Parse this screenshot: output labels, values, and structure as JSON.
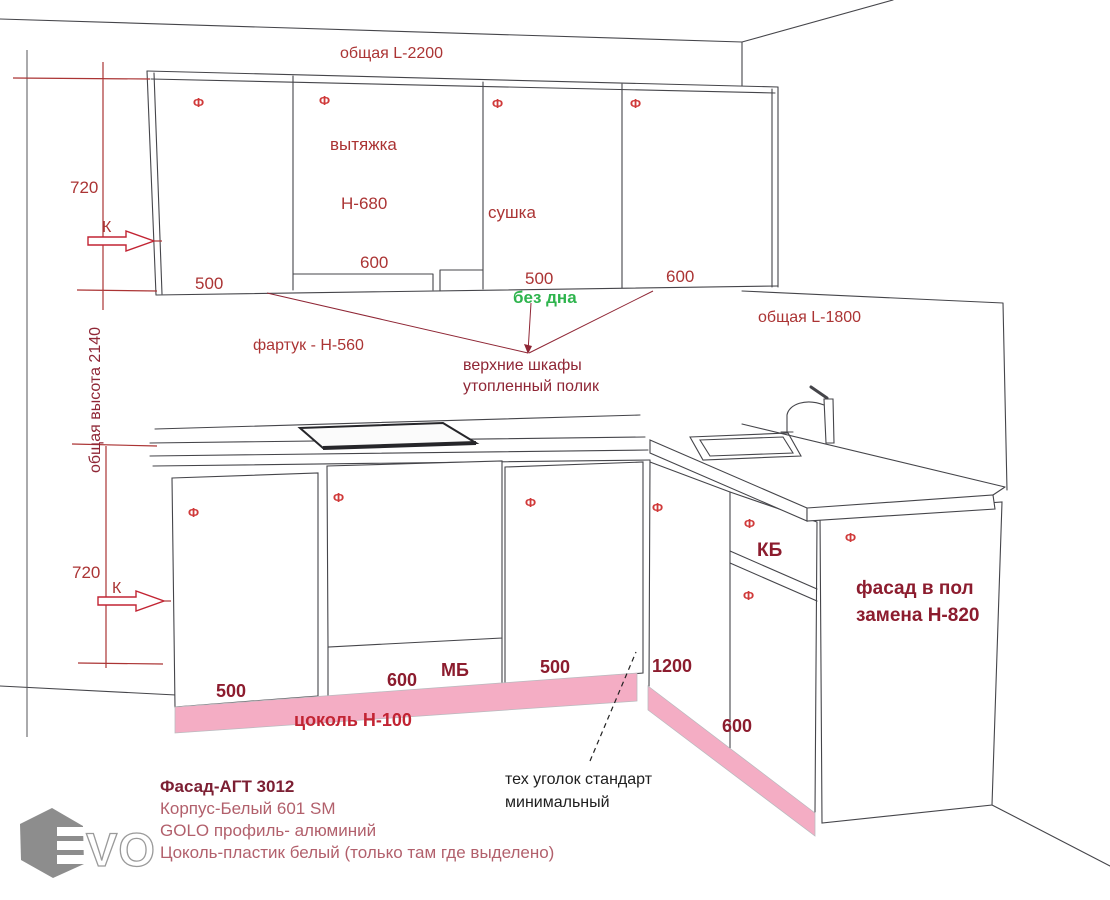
{
  "colors": {
    "dim_red": "#ab3434",
    "note_maroon": "#8f2635",
    "bold_maroon": "#8c1c2e",
    "bright_red": "#c22433",
    "green": "#2eb44d",
    "plinth_pink": "#f4adc4",
    "legend_rose": "#b2606c",
    "legend_dark": "#7c1f33",
    "text_black": "#1e1e1e",
    "line_gray": "#45454a",
    "logo_gray": "#8d8d8d"
  },
  "marks": {
    "facade": "Ф"
  },
  "dimensions": {
    "upper_total": "общая L-2200",
    "right_total": "общая L-1800",
    "overall_height": "общая высота 2140",
    "upper_height": "720",
    "lower_height": "720",
    "k_mark_upper": "К",
    "k_mark_lower": "К"
  },
  "upper_run": {
    "cabinet1_width": "500",
    "hood_label": "вытяжка",
    "hood_door_height": "Н-680",
    "hood_width": "600",
    "dryer_label": "сушка",
    "dryer_width": "500",
    "dryer_note": "без дна",
    "cabinet4_width": "600",
    "apron_note": "фартук - Н-560",
    "shelf_note_line1": "верхние шкафы",
    "shelf_note_line2": "утопленный полик"
  },
  "lower_run": {
    "cabinet1_width": "500",
    "mb_width": "600",
    "mb_label": "МБ",
    "cabinet3_width": "500",
    "corner_width": "1200",
    "kb_label": "КБ",
    "right_width": "600",
    "plinth_label": "цоколь Н-100",
    "facade_note_line1": "фасад в пол",
    "facade_note_line2": "замена Н-820",
    "tech_note_line1": "тех уголок стандарт",
    "tech_note_line2": "минимальный"
  },
  "legend": {
    "line1": "Фасад-АГТ 3012",
    "line2": "Корпус-Белый 601 SM",
    "line3": "GOLO профиль- алюминий",
    "line4": "Цоколь-пластик белый (только там где выделено)"
  },
  "logo": {
    "text": "VO"
  }
}
